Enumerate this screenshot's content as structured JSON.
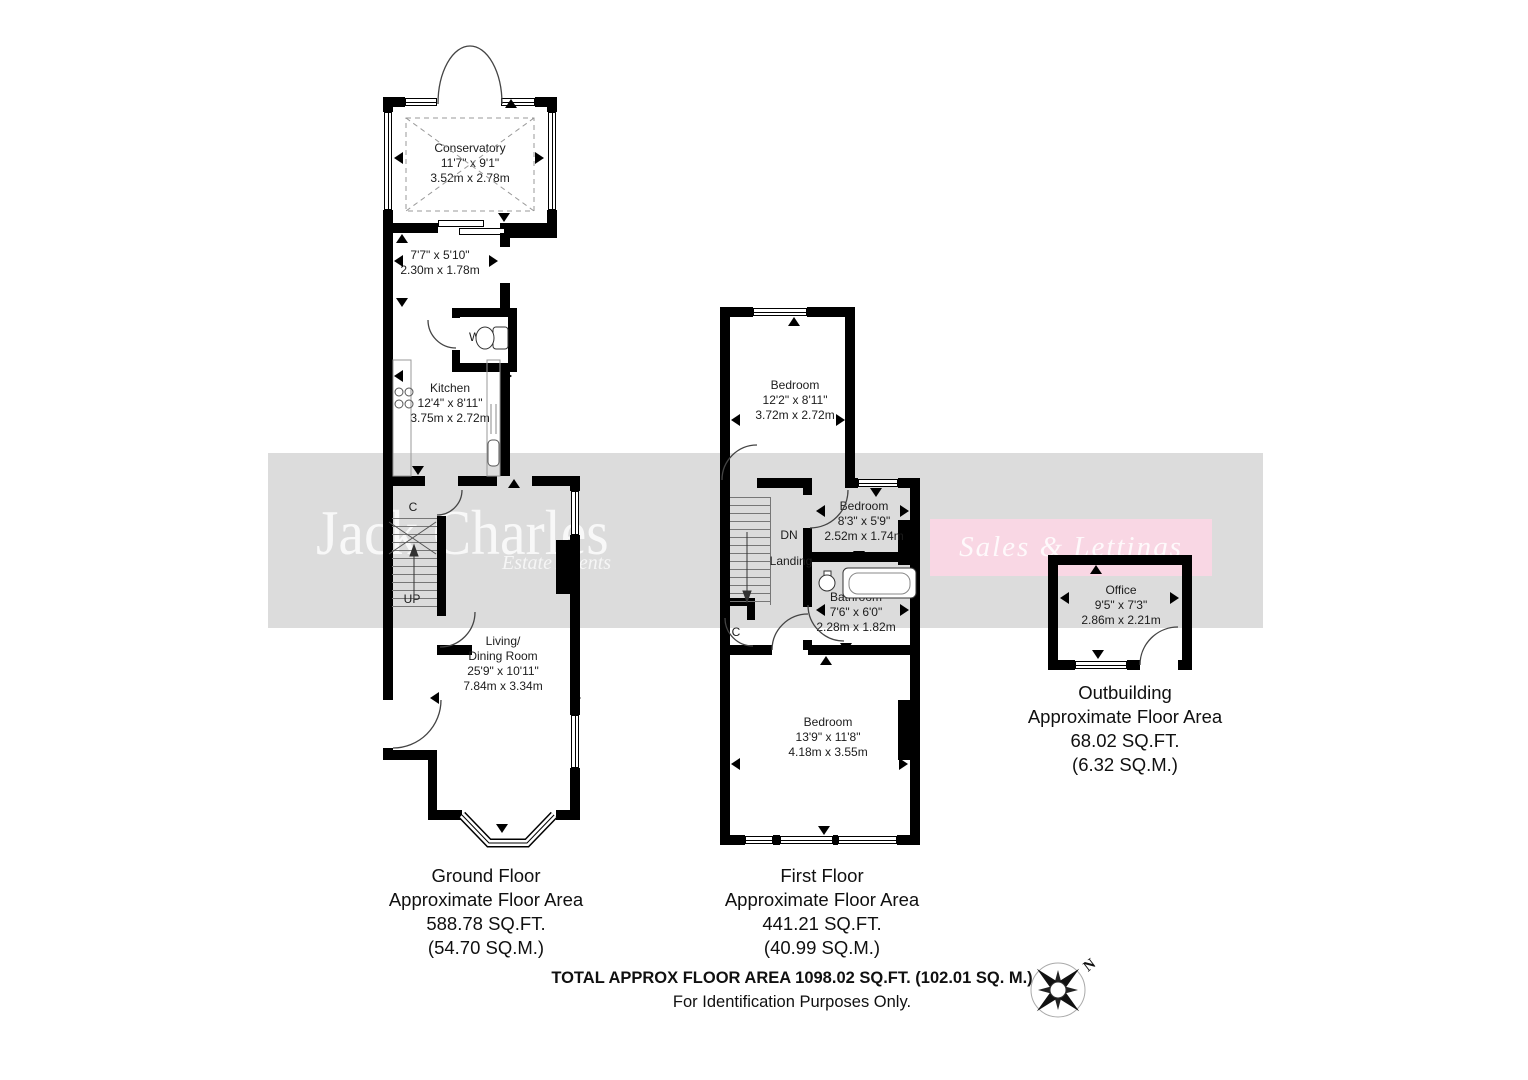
{
  "watermark": {
    "brand": "Jack Charles",
    "tagline": "Estate Agents",
    "banner": "Sales & Lettings"
  },
  "colors": {
    "band": "#dcdcdc",
    "banner_pink": "#f9d7e4",
    "wall": "#000000"
  },
  "ground_floor": {
    "caption": {
      "line1": "Ground Floor",
      "line2": "Approximate Floor Area",
      "line3": "588.78 SQ.FT.",
      "line4": "(54.70 SQ.M.)"
    },
    "conservatory": {
      "name": "Conservatory",
      "dims_ft": "11'7\" x 9'1\"",
      "dims_m": "3.52m x 2.78m"
    },
    "hall": {
      "dims_ft": "7'7\" x 5'10\"",
      "dims_m": "2.30m x 1.78m"
    },
    "wc": {
      "name": "WC"
    },
    "kitchen": {
      "name": "Kitchen",
      "dims_ft": "12'4\" x 8'11\"",
      "dims_m": "3.75m x 2.72m"
    },
    "living_dining": {
      "name_line1": "Living/",
      "name_line2": "Dining Room",
      "dims_ft": "25'9\" x 10'11\"",
      "dims_m": "7.84m x 3.34m"
    },
    "stairs_label": "UP",
    "cupboard_label": "C"
  },
  "first_floor": {
    "caption": {
      "line1": "First Floor",
      "line2": "Approximate Floor Area",
      "line3": "441.21 SQ.FT.",
      "line4": "(40.99 SQ.M.)"
    },
    "bedroom_rear": {
      "name": "Bedroom",
      "dims_ft": "12'2\" x 8'11\"",
      "dims_m": "3.72m x 2.72m"
    },
    "bedroom_middle": {
      "name": "Bedroom",
      "dims_ft": "8'3\" x 5'9\"",
      "dims_m": "2.52m x 1.74m"
    },
    "bathroom": {
      "name": "Bathroom",
      "dims_ft": "7'6\" x 6'0\"",
      "dims_m": "2.28m x 1.82m"
    },
    "bedroom_front": {
      "name": "Bedroom",
      "dims_ft": "13'9\" x 11'8\"",
      "dims_m": "4.18m x 3.55m"
    },
    "stairs_label": "DN",
    "landing_label": "Landing",
    "cupboard_label": "C"
  },
  "outbuilding": {
    "caption": {
      "line1": "Outbuilding",
      "line2": "Approximate Floor Area",
      "line3": "68.02 SQ.FT.",
      "line4": "(6.32 SQ.M.)"
    },
    "office": {
      "name": "Office",
      "dims_ft": "9'5\" x 7'3\"",
      "dims_m": "2.86m x 2.21m"
    }
  },
  "footer": {
    "line1": "TOTAL APPROX FLOOR AREA 1098.02 SQ.FT. (102.01 SQ. M.)",
    "line2": "For Identification Purposes Only."
  },
  "compass": {
    "north_label": "N"
  }
}
